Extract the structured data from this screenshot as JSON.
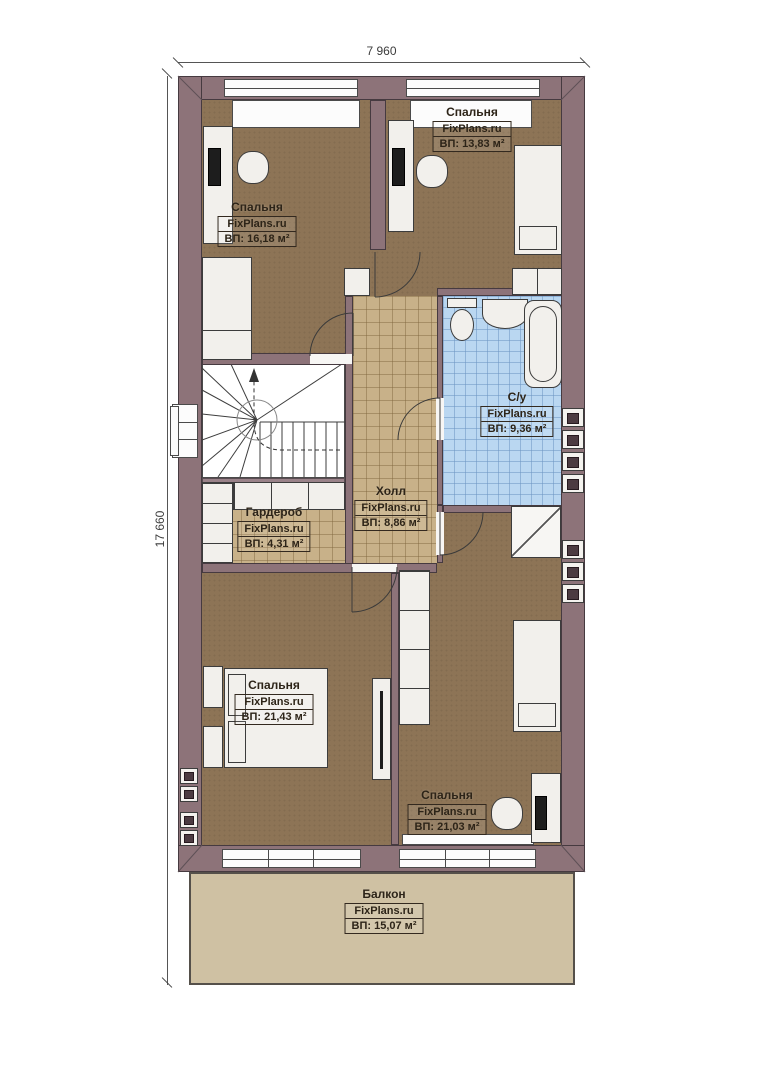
{
  "dimensions": {
    "top": "7 960",
    "left": "17 660"
  },
  "rooms": {
    "bedroom_tl": {
      "name": "Спальня",
      "watermark": "FixPlans.ru",
      "area": "ВП: 16,18 м²"
    },
    "bedroom_tr": {
      "name": "Спальня",
      "watermark": "FixPlans.ru",
      "area": "ВП: 13,83 м²"
    },
    "bathroom": {
      "name": "С/у",
      "watermark": "FixPlans.ru",
      "area": "ВП: 9,36 м²"
    },
    "hall": {
      "name": "Холл",
      "watermark": "FixPlans.ru",
      "area": "ВП: 8,86 м²"
    },
    "wardrobe": {
      "name": "Гардероб",
      "watermark": "FixPlans.ru",
      "area": "ВП: 4,31 м²"
    },
    "bedroom_bl": {
      "name": "Спальня",
      "watermark": "FixPlans.ru",
      "area": "ВП: 21,43 м²"
    },
    "bedroom_br": {
      "name": "Спальня",
      "watermark": "FixPlans.ru",
      "area": "ВП: 21,03 м²"
    },
    "balcony": {
      "name": "Балкон",
      "watermark": "FixPlans.ru",
      "area": "ВП: 15,07 м²"
    }
  },
  "colors": {
    "wall": "#8d7379",
    "bedroom_floor": "#8d7456",
    "tile_floor": "#c8b189",
    "bathroom_tile": "#bad7f1",
    "balcony_floor": "#cfc1a3"
  }
}
